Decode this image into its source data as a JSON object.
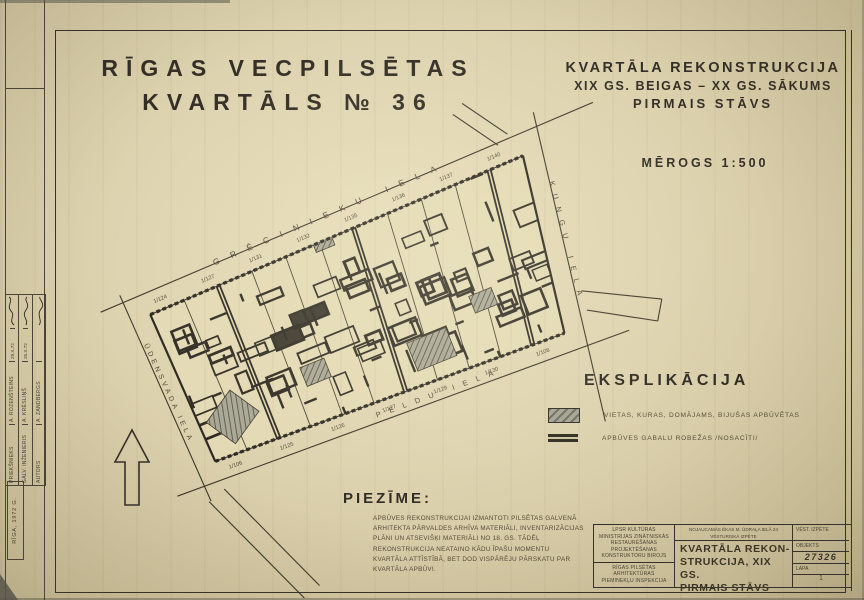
{
  "sheet": {
    "title_line1": "RĪGAS VECPILSĒTAS",
    "title_line2": "KVARTĀLS № 36",
    "heading_line1": "KVARTĀLA REKONSTRUKCIJA",
    "heading_line2": "XIX GS. BEIGAS – XX GS. SĀKUMS",
    "heading_line3": "PIRMAIS STĀVS",
    "scale": "MĒROGS 1:500"
  },
  "plan": {
    "streets": {
      "top": "GRĒCINIEKU IELA",
      "right": "KUNGU IELA",
      "bottom": "PELDU IELA",
      "left": "ŪDENSVADA IELA"
    },
    "parcels_top": [
      "1/124",
      "1/127",
      "1/131",
      "1/132",
      "1/135",
      "1/136",
      "1/137",
      "1/140"
    ],
    "parcels_bottom": [
      "1/106",
      "1/125",
      "1/126",
      "1/127",
      "1/129",
      "1/130",
      "1/108"
    ]
  },
  "legend": {
    "heading": "EKSPLIKĀCIJA",
    "items": [
      {
        "symbol": "hatched-area",
        "label": "VIETAS, KURAS, DOMĀJAMS, BIJUŠAS APBŪVĒTAS"
      },
      {
        "symbol": "double-line",
        "label": "APBŪVES GABALU ROBEŽAS /NOSACĪTI/"
      }
    ]
  },
  "note": {
    "heading": "PIEZĪME:",
    "body": "APBŪVES REKONSTRUKCIJAI IZMANTOTI PILSĒTAS GALVENĀ ARHITEKTA PĀRVALDES ARHĪVA MATERIĀLI, INVENTARIZĀCIJAS PLĀNI UN ATSEVIŠĶI MATERIĀLI NO 18. GS. TĀDĒĻ REKONSTRUKCIJA NEATAINO KĀDU ĪPAŠU MOMENTU KVARTĀLA ATTĪSTĪBĀ, BET DOD VISPĀRĒJU PĀRSKATU PAR KVARTĀLA APBŪVI."
  },
  "title_block": {
    "org1": "LPSR KULTŪRAS MINISTRIJAS ZINĀTNISKĀS RESTAURĒŠANAS PROJEKTĒŠANAS KONSTRUKTORU BIROJS",
    "org2": "RĪGAS PILSĒTAS ARHITEKTŪRAS PIEMINEKĻU INSPEKCIJA",
    "project_line1": "NOJAUCAMĀS ĒKAS M. ŪDRAĻA IELĀ 24",
    "project_line2": "VĒSTURISKĀ IZPĒTE",
    "title_line1": "KVARTĀLA REKON-",
    "title_line2": "STRUKCIJA, XIX GS.",
    "title_line3": "PIRMAIS STĀVS",
    "stage": "VĒST. IZPĒTE",
    "object_label": "OBJEKTS",
    "object_number": "27326",
    "sheet_label": "LAPA",
    "sheet_number": "1"
  },
  "signatures": {
    "rows": [
      {
        "role": "PRIEKŠNIEKS",
        "name": "A. ROZENŠTEINS",
        "date": "29.X.72"
      },
      {
        "role": "GALV. INŽENIERIS",
        "name": "A. KRĒSLIŅŠ",
        "date": "25.X.72"
      },
      {
        "role": "AUTORS",
        "name": "A. ZANDBERGS",
        "date": ""
      }
    ],
    "footer": "RĪGA, 1972 G."
  }
}
